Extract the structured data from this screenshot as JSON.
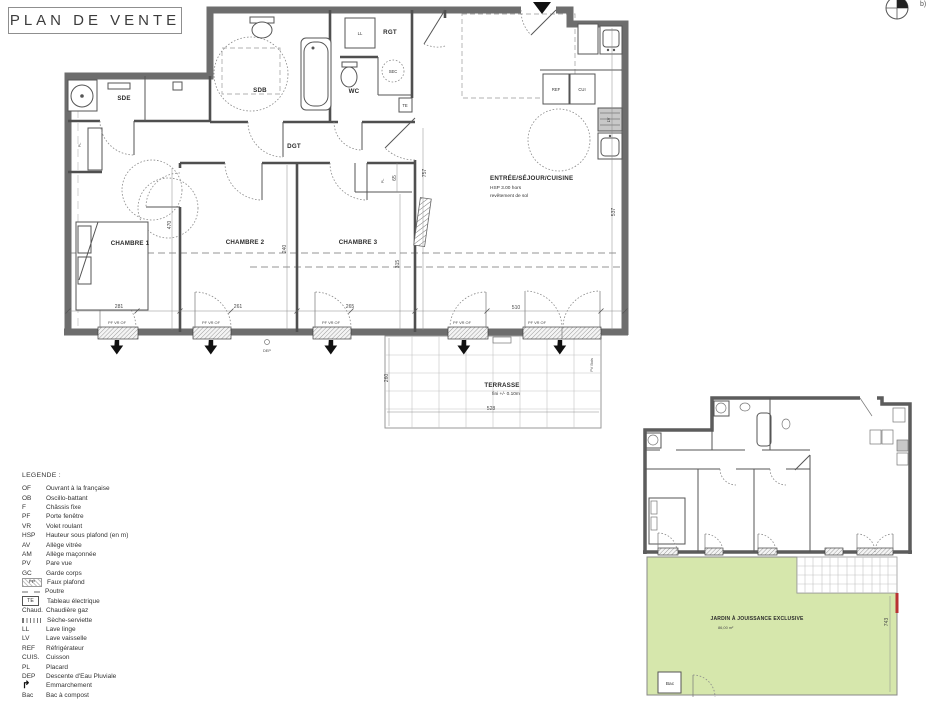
{
  "title": "PLAN DE VENTE",
  "compass_note": "b)",
  "colors": {
    "wall": "#6d6d6d",
    "garden": "#d6e7ac",
    "accent_red": "#b83232"
  },
  "main_plan": {
    "rooms": {
      "sde": "SDE",
      "sdb": "SDB",
      "wc": "WC",
      "rgt": "RGT",
      "dgt": "DGT",
      "chambre1": "CHAMBRE 1",
      "chambre2": "CHAMBRE 2",
      "chambre3": "CHAMBRE 3",
      "sejour_line1": "ENTRÉE/SÉJOUR/CUISINE",
      "sejour_line2": "HSP 3.00 hors",
      "sejour_line3": "revêtement de sol",
      "terrasse": "TERRASSE",
      "terrasse_note": "fini +/- 0.10m"
    },
    "fixtures": {
      "ll": "LL",
      "sec": "SEC",
      "te": "TE",
      "ref": "REF",
      "cui": "CUI",
      "lv": "LV",
      "pl": "PL"
    },
    "window_label": "PF VR OF",
    "dep_label": "DEP",
    "pv_bois": "PV Bois",
    "dims": {
      "w1": "281",
      "w2": "261",
      "w3": "265",
      "w4": "510",
      "t_w": "528",
      "t_h": "260",
      "h1": "470",
      "h2": "240",
      "h3": "315",
      "h4": "65",
      "h5": "757",
      "h6": "537"
    }
  },
  "key_plan": {
    "garden_title": "JARDIN À JOUISSANCE EXCLUSIVE",
    "garden_area": "86,00 m²",
    "garden_dim": "743",
    "bac_label": "Bac"
  },
  "legend": {
    "title": "LEGENDE :",
    "items": [
      {
        "abbr": "OF",
        "label": "Ouvrant à la française"
      },
      {
        "abbr": "OB",
        "label": "Oscillo-battant"
      },
      {
        "abbr": "F",
        "label": "Châssis fixe"
      },
      {
        "abbr": "PF",
        "label": "Porte fenêtre"
      },
      {
        "abbr": "VR",
        "label": "Volet roulant"
      },
      {
        "abbr": "HSP",
        "label": "Hauteur sous plafond (en m)"
      },
      {
        "abbr": "AV",
        "label": "Allège vitrée"
      },
      {
        "abbr": "AM",
        "label": "Allège maçonnée"
      },
      {
        "abbr": "PV",
        "label": "Pare vue"
      },
      {
        "abbr": "GC",
        "label": "Garde corps"
      },
      {
        "abbr": "FP",
        "label": "Faux plafond",
        "sym": "fp"
      },
      {
        "abbr": "",
        "label": "Poutre",
        "sym": "dash"
      },
      {
        "abbr": "TE",
        "label": "Tableau électrique",
        "sym": "te"
      },
      {
        "abbr": "Chaud.",
        "label": "Chaudière gaz"
      },
      {
        "abbr": "",
        "label": "Sèche-serviette",
        "sym": "seche"
      },
      {
        "abbr": "LL",
        "label": "Lave linge"
      },
      {
        "abbr": "LV",
        "label": "Lave vaisselle"
      },
      {
        "abbr": "REF",
        "label": "Réfrigérateur"
      },
      {
        "abbr": "CUIS.",
        "label": "Cuisson"
      },
      {
        "abbr": "PL",
        "label": "Placard"
      },
      {
        "abbr": "DEP",
        "label": "Descente d'Eau Pluviale"
      },
      {
        "abbr": "",
        "label": "Emmarchement",
        "sym": "arrow"
      },
      {
        "abbr": "Bac",
        "label": "Bac à compost"
      }
    ]
  }
}
